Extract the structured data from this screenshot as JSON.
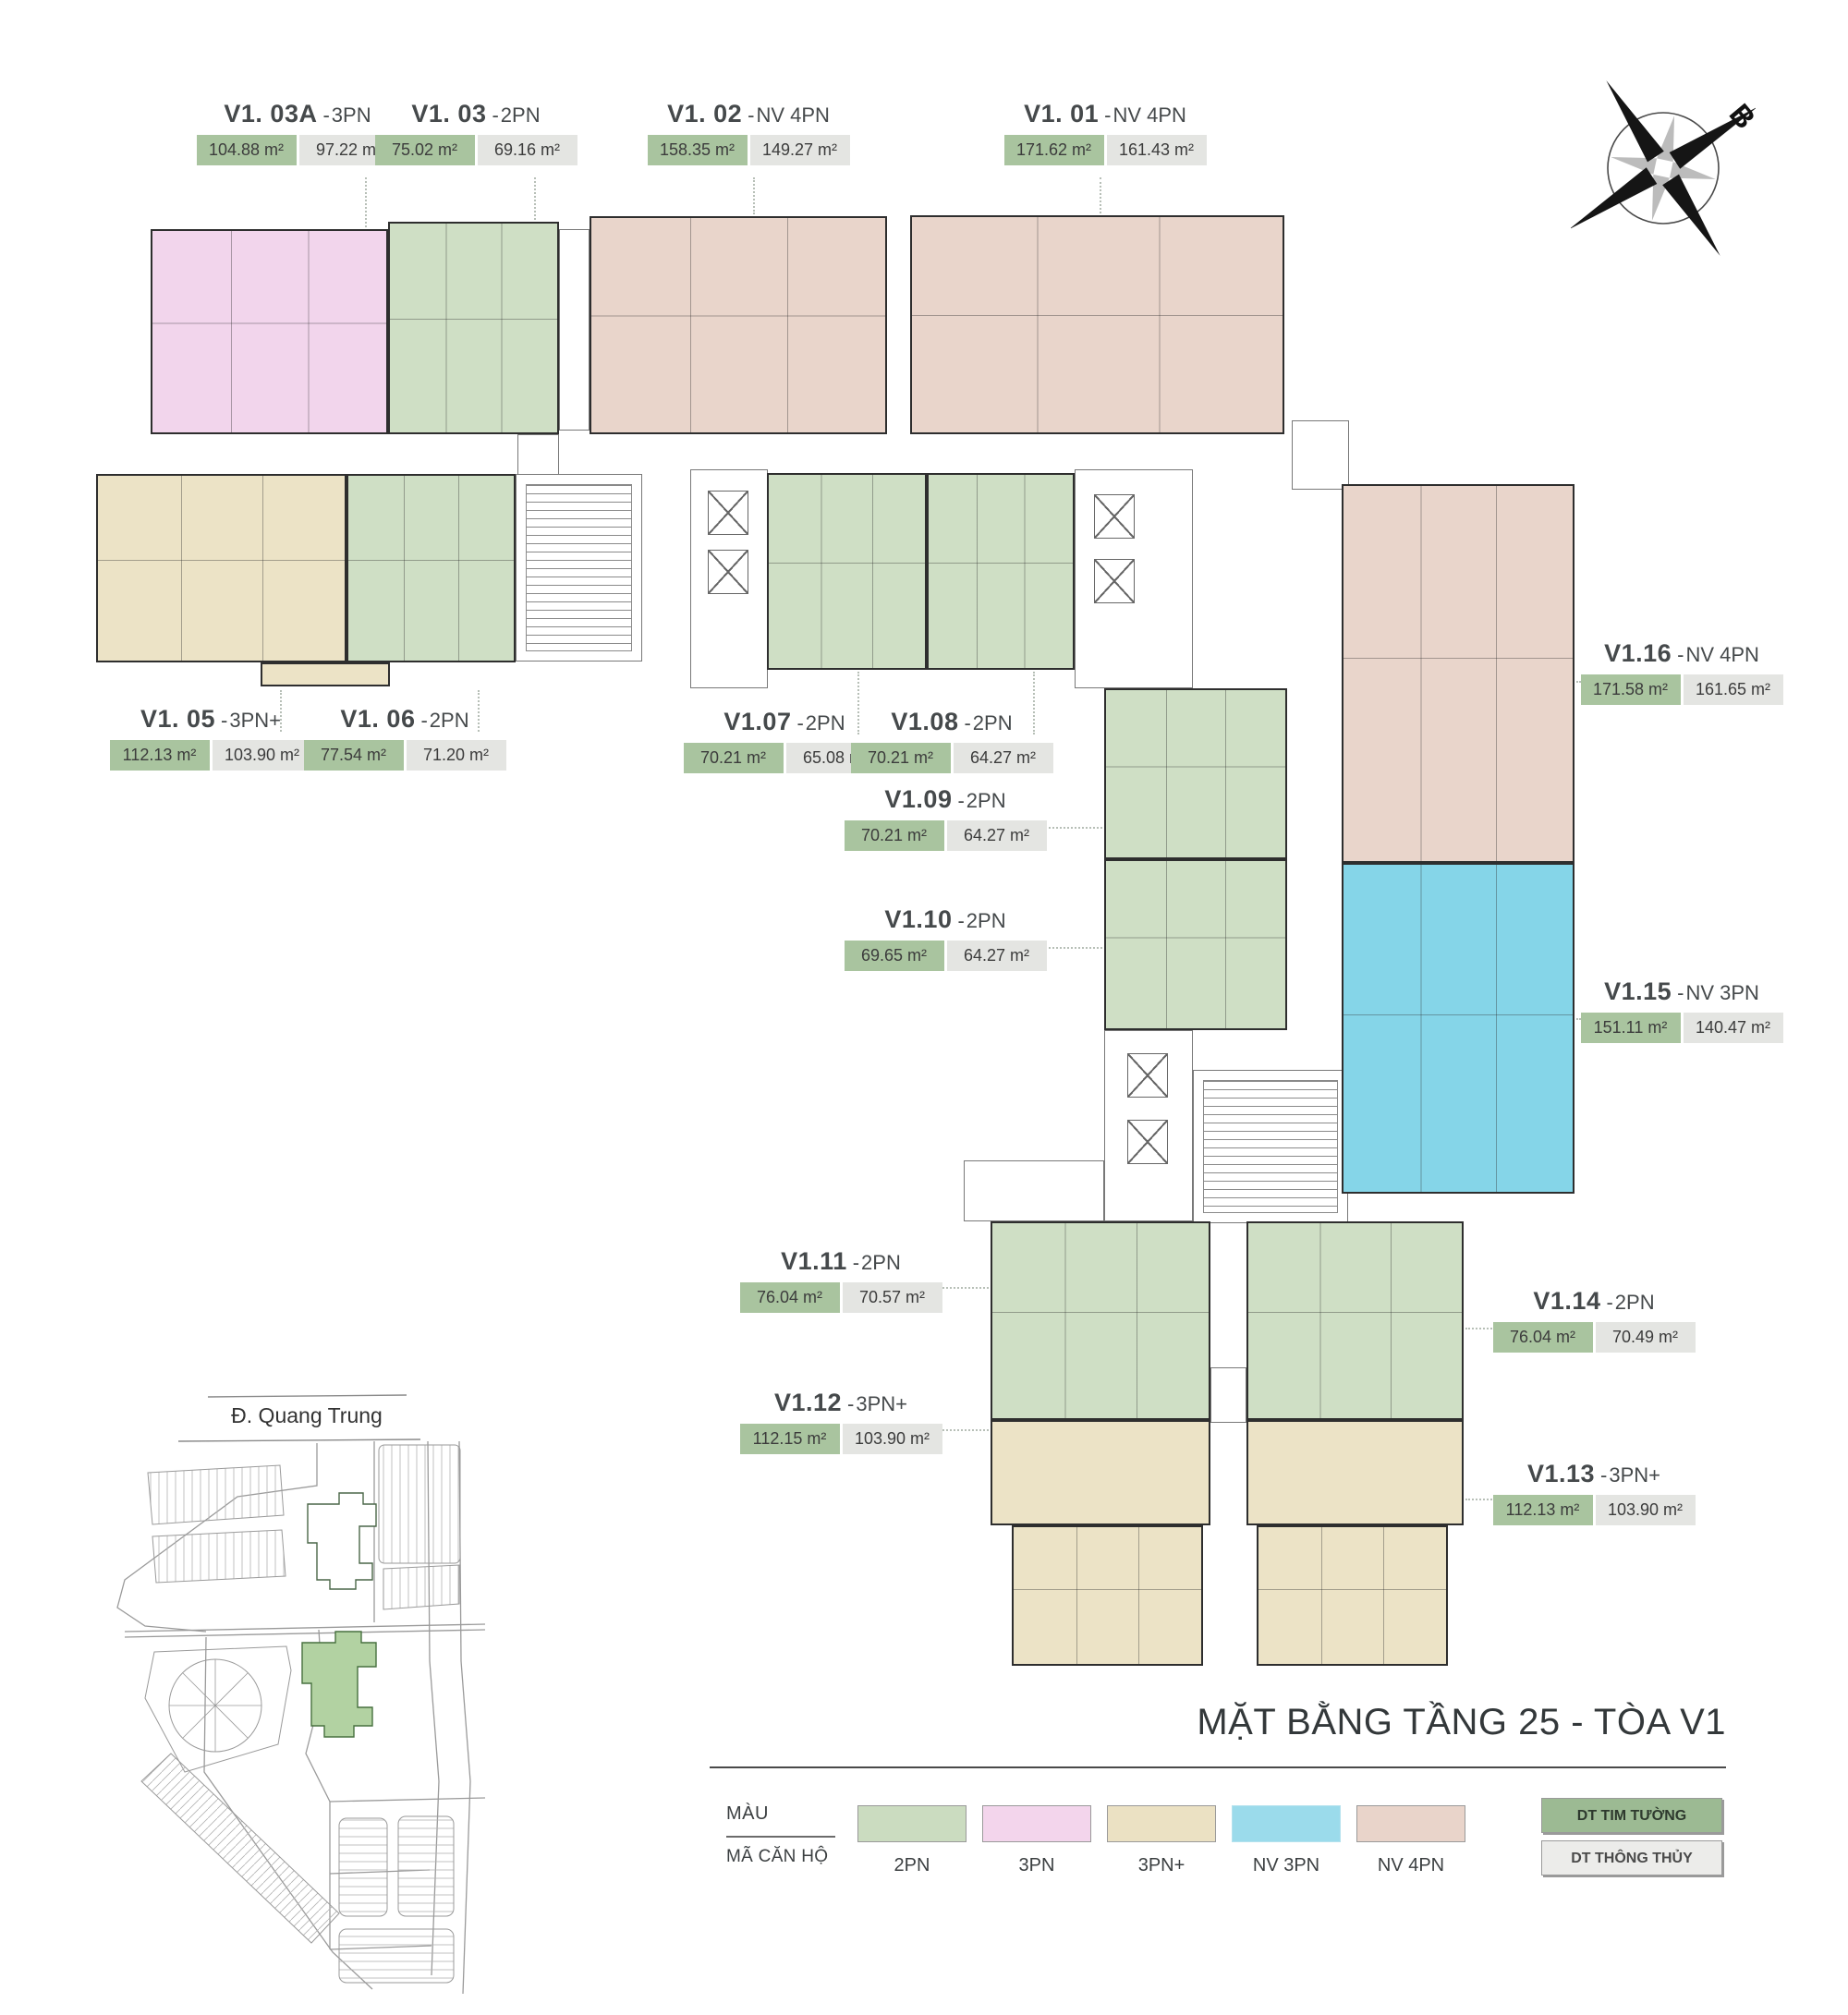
{
  "page": {
    "title": "MẶT BẰNG TẦNG 25 - TÒA V1"
  },
  "compass": {
    "north_label": "B"
  },
  "site_map": {
    "street_label": "Đ. Quang Trung"
  },
  "labels": {
    "sep": "-"
  },
  "legend": {
    "color_label": "MÀU",
    "code_label": "MÃ CĂN HỘ",
    "categories": [
      {
        "code": "2PN",
        "color": "#cbdcc0"
      },
      {
        "code": "3PN",
        "color": "#f3d5ec"
      },
      {
        "code": "3PN+",
        "color": "#ebe1c3"
      },
      {
        "code": "NV 3PN",
        "color": "#9bdbeb"
      },
      {
        "code": "NV 4PN",
        "color": "#e9d4ca"
      }
    ],
    "badges": [
      {
        "label": "DT TIM TƯỜNG",
        "color": "#9cba93"
      },
      {
        "label": "DT THÔNG THỦY",
        "color": "#ececea"
      }
    ]
  },
  "units": [
    {
      "code": "V1. 03A",
      "type": "3PN",
      "gross": "104.88 m²",
      "net": "97.22 m²"
    },
    {
      "code": "V1. 03",
      "type": "2PN",
      "gross": "75.02 m²",
      "net": "69.16 m²"
    },
    {
      "code": "V1. 02",
      "type": "NV 4PN",
      "gross": "158.35 m²",
      "net": "149.27 m²"
    },
    {
      "code": "V1. 01",
      "type": "NV 4PN",
      "gross": "171.62 m²",
      "net": "161.43 m²"
    },
    {
      "code": "V1. 05",
      "type": "3PN+",
      "gross": "112.13 m²",
      "net": "103.90 m²"
    },
    {
      "code": "V1. 06",
      "type": "2PN",
      "gross": "77.54 m²",
      "net": "71.20 m²"
    },
    {
      "code": "V1.07",
      "type": "2PN",
      "gross": "70.21 m²",
      "net": "65.08 m²"
    },
    {
      "code": "V1.08",
      "type": "2PN",
      "gross": "70.21 m²",
      "net": "64.27 m²"
    },
    {
      "code": "V1.09",
      "type": "2PN",
      "gross": "70.21 m²",
      "net": "64.27 m²"
    },
    {
      "code": "V1.10",
      "type": "2PN",
      "gross": "69.65 m²",
      "net": "64.27 m²"
    },
    {
      "code": "V1.16",
      "type": "NV 4PN",
      "gross": "171.58 m²",
      "net": "161.65 m²"
    },
    {
      "code": "V1.15",
      "type": "NV 3PN",
      "gross": "151.11 m²",
      "net": "140.47 m²"
    },
    {
      "code": "V1.11",
      "type": "2PN",
      "gross": "76.04 m²",
      "net": "70.57 m²"
    },
    {
      "code": "V1.12",
      "type": "3PN+",
      "gross": "112.15 m²",
      "net": "103.90 m²"
    },
    {
      "code": "V1.14",
      "type": "2PN",
      "gross": "76.04 m²",
      "net": "70.49 m²"
    },
    {
      "code": "V1.13",
      "type": "3PN+",
      "gross": "112.13 m²",
      "net": "103.90 m²"
    }
  ]
}
